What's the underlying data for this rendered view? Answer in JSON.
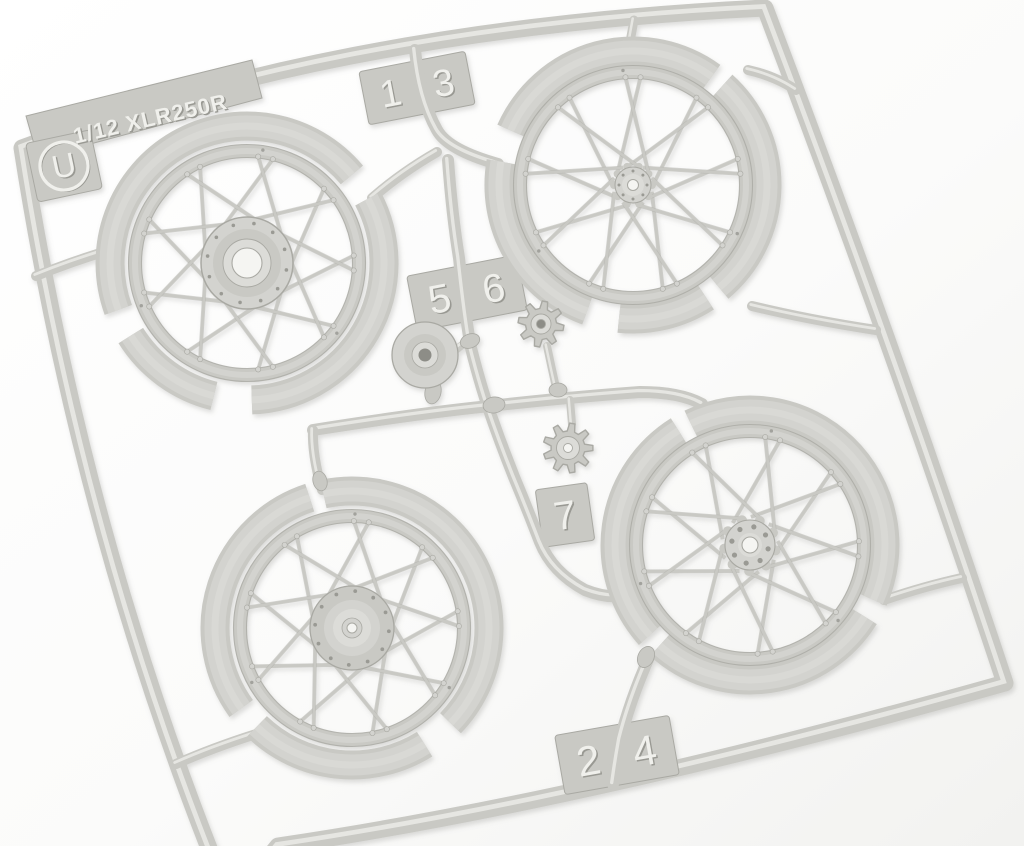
{
  "scene": {
    "subject": "light-grey injection-molded model kit sprue (runner) holding four wire-spoked motorcycle wheels, two chain sprockets and a hub cone on a white background",
    "wheel_count": "4",
    "sprocket_count": "2"
  },
  "labels": {
    "scale_text": "1/12 XLR250R",
    "sprue_letter": "U"
  },
  "tags": {
    "t13": [
      "1",
      "3"
    ],
    "t56": [
      "5",
      "6"
    ],
    "t7": [
      "7"
    ],
    "t24": [
      "2",
      "4"
    ]
  },
  "colors": {
    "bg": "#ffffff",
    "tint": "#f2f2f0",
    "base": "#c9c9c4",
    "face": "#d3d3cf",
    "light": "#dcdcd8",
    "hl": "#ebebe8",
    "edge": "#a9a9a3",
    "shadow": "#9a9a94",
    "emboss": "#f0f0ec",
    "embosssh": "#999993",
    "hole": "#8d8d87",
    "holebright": "#f5f5f2"
  }
}
